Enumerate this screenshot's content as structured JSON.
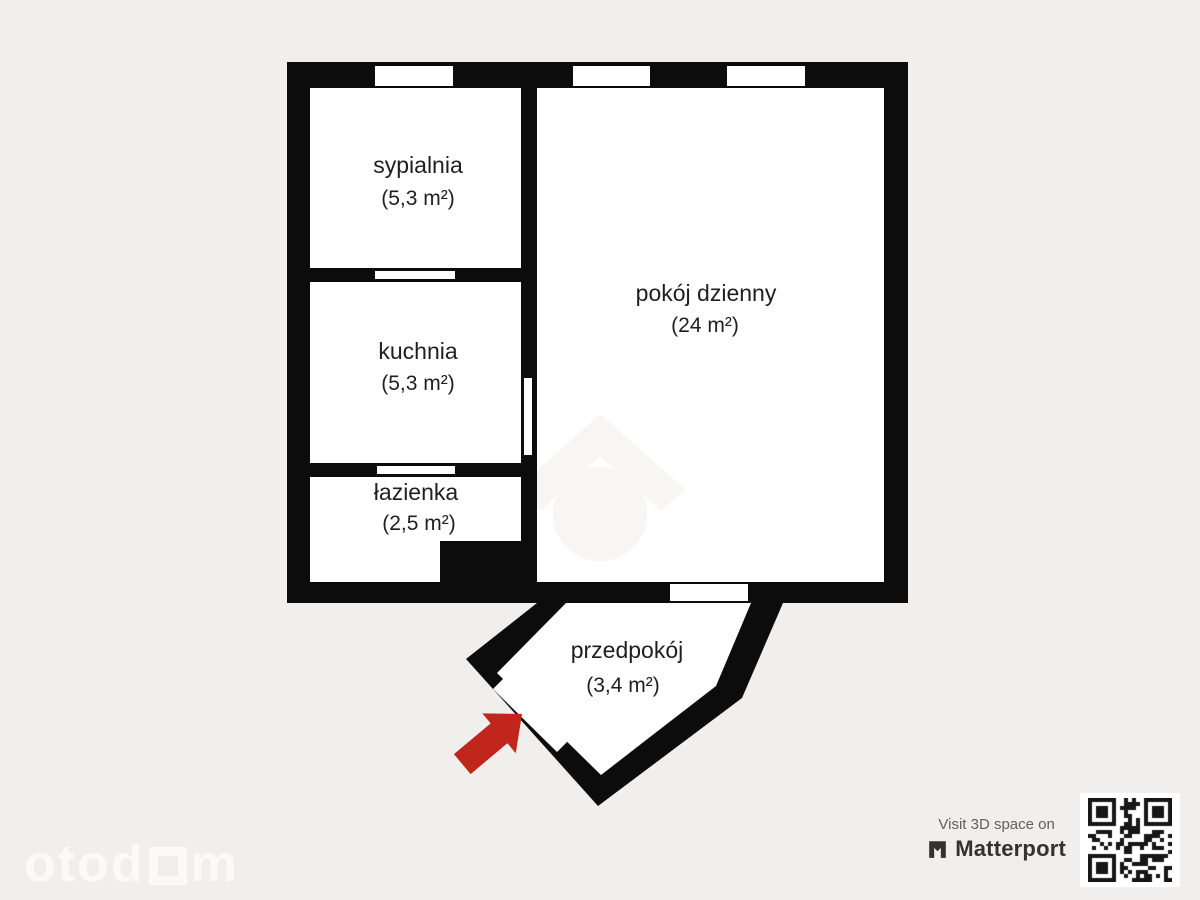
{
  "plan": {
    "rooms": [
      {
        "name": "sypialnia",
        "area": "(5,3 m²)"
      },
      {
        "name": "kuchnia",
        "area": "(5,3 m²)"
      },
      {
        "name": "łazienka",
        "area": "(2,5 m²)"
      },
      {
        "name": "pokój dzienny",
        "area": "(24 m²)"
      },
      {
        "name": "przedpokój",
        "area": "(3,4 m²)"
      }
    ],
    "colors": {
      "wall": "#0c0c0c",
      "room": "#ffffff",
      "background": "#f1efed",
      "entrance_arrow": "#c1261c",
      "watermark": "#f8f6f3"
    },
    "icons": {
      "entrance_arrow": "arrow-up-right",
      "watermark_house": "house-logo"
    }
  },
  "branding": {
    "otodom_part1": "otod",
    "otodom_part2": "m",
    "matterport": {
      "tagline": "Visit 3D space on",
      "name": "Matterport"
    }
  }
}
